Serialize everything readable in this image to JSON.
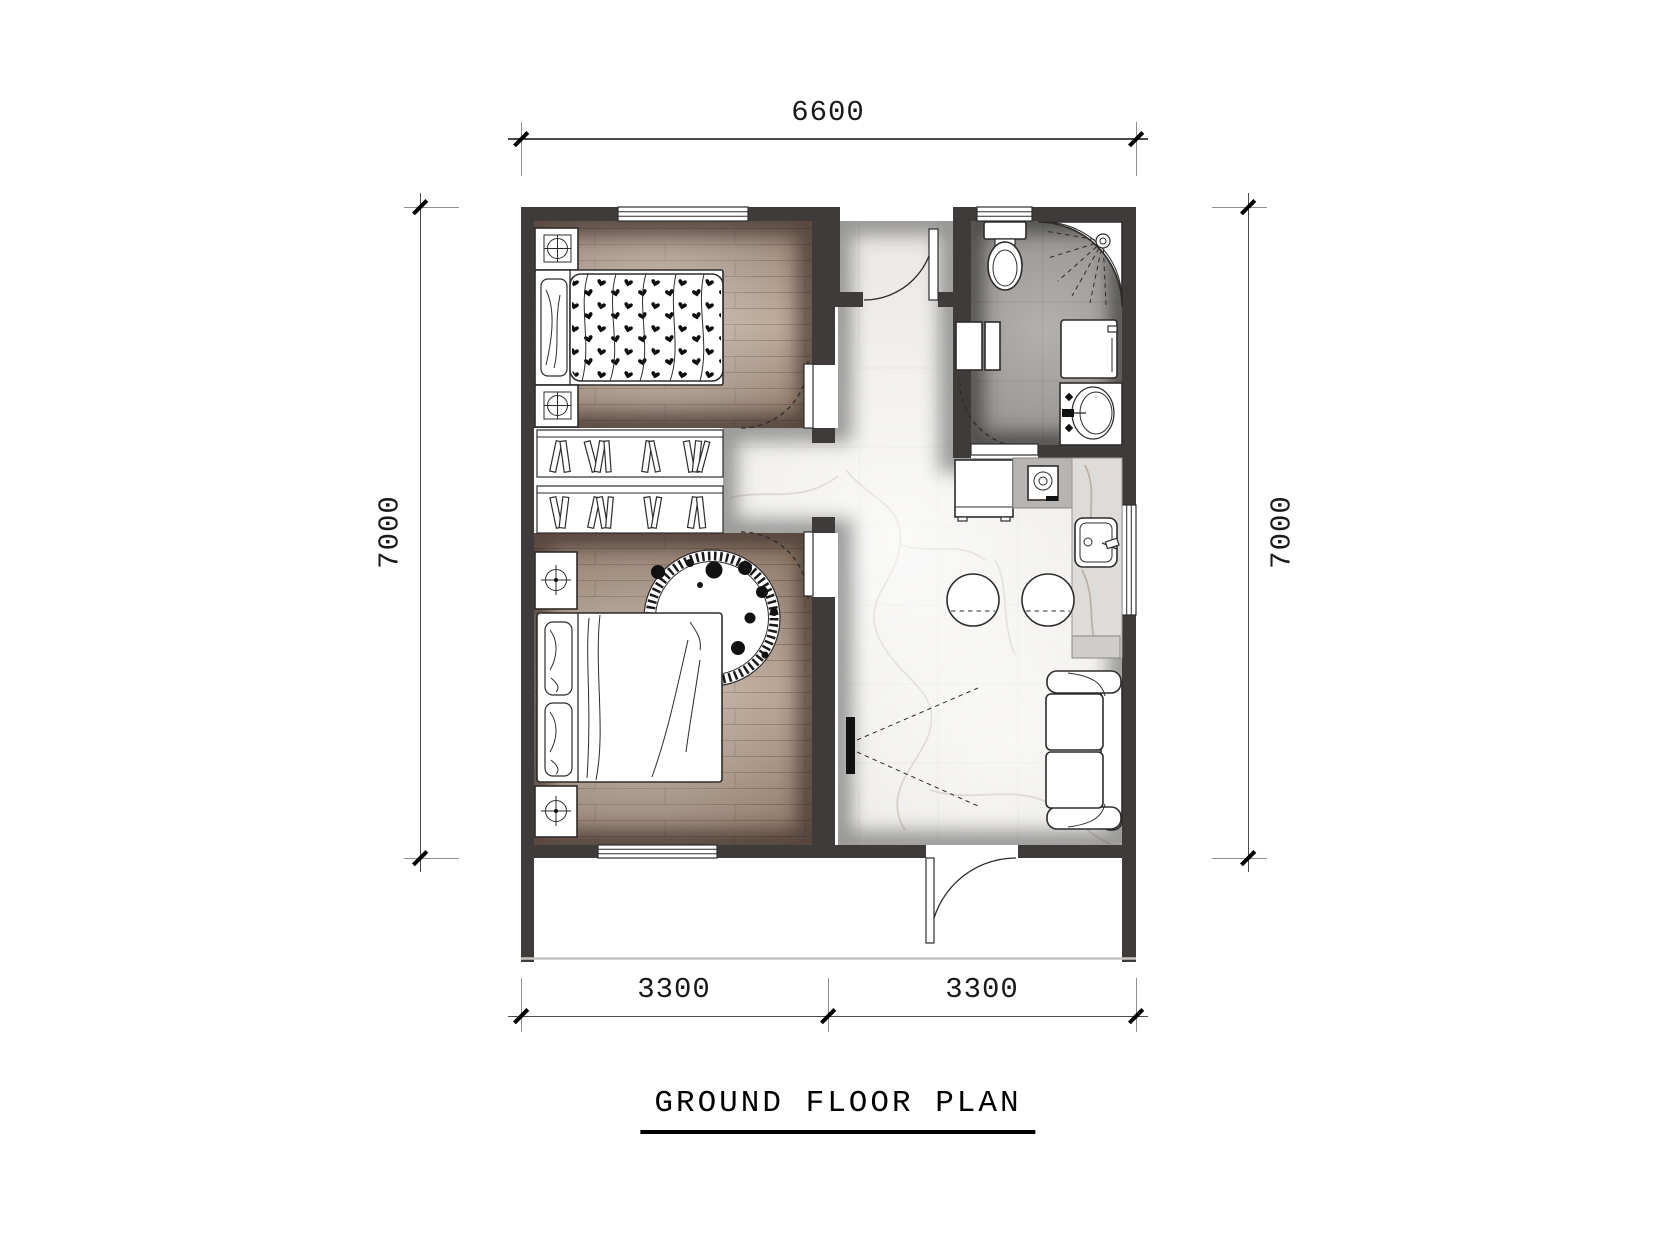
{
  "title": "GROUND FLOOR PLAN",
  "dims": {
    "top": "6600",
    "left": "7000",
    "right": "7000",
    "bottom_left": "3300",
    "bottom_right": "3300"
  },
  "palette": {
    "wall": "#3f3b3b",
    "wood": "#a5907e",
    "marble": "#f7f6f3",
    "bath": "#95928f",
    "line": "#2e2b2b",
    "dim": "#1a1a1a"
  }
}
